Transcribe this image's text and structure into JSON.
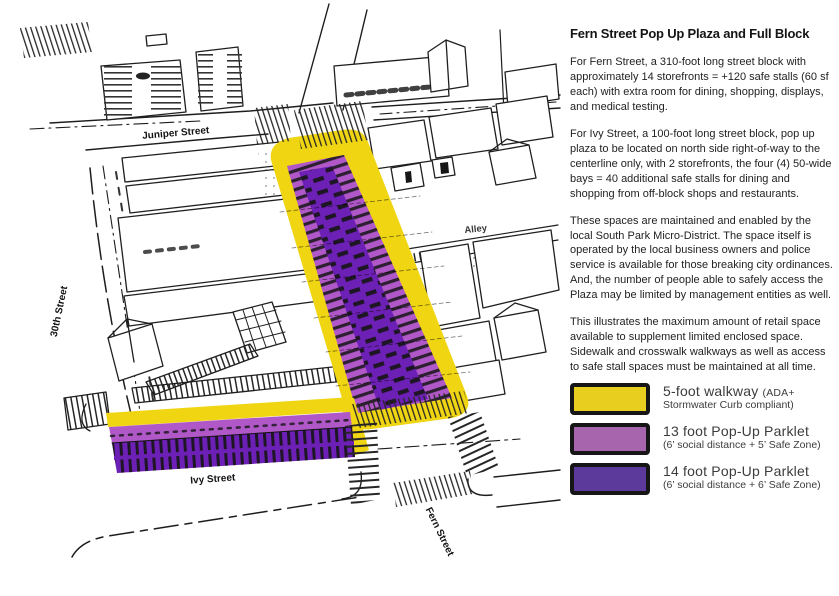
{
  "title": "Fern Street Pop Up Plaza and Full Block",
  "paragraphs": [
    "For Fern Street, a 310-foot long street block with approximately 14 storefronts = +120 safe stalls (60 sf each) with extra room for dining, shopping, displays, and medical testing.",
    "For Ivy Street, a 100-foot long street block, pop up plaza to be located on north side right-of-way to the centerline only, with 2 storefronts, the four (4) 50-wide bays = 40 additional safe stalls for dining and shopping from off-block shops and restaurants.",
    "These spaces are maintained and enabled by the local South Park Micro-District. The space itself is operated by the local business owners and police service is available for those breaking city ordinances. And, the number of people able to safely access the Plaza may be limited by management entities as well.",
    "This illustrates the maximum amount of retail space available to supplement limited enclosed space. Sidewalk and crosswalk walkways as well as access to safe stall spaces must be maintained at all time."
  ],
  "legend": [
    {
      "main": "5-foot walkway",
      "tail": "(ADA+",
      "sub": "Stormwater Curb compliant)",
      "color": "#E8CE1E"
    },
    {
      "main": "13 foot Pop-Up Parklet",
      "tail": "",
      "sub": "(6’ social distance + 5’ Safe Zone)",
      "color": "#A765AE"
    },
    {
      "main": "14 foot Pop-Up Parklet",
      "tail": "",
      "sub": "(6’ social distance + 6’ Safe Zone)",
      "color": "#5B3A9B"
    }
  ],
  "map": {
    "street_labels": {
      "juniper": "Juniper Street",
      "alley": "Alley",
      "thirtieth": "30th Street",
      "ivy": "Ivy Street",
      "fern": "Fern Street"
    },
    "colors": {
      "walkway_yellow": "#F0D513",
      "parklet_light": "#B158C9",
      "parklet_dark": "#6D20B5",
      "ink": "#1d1d1d"
    }
  }
}
